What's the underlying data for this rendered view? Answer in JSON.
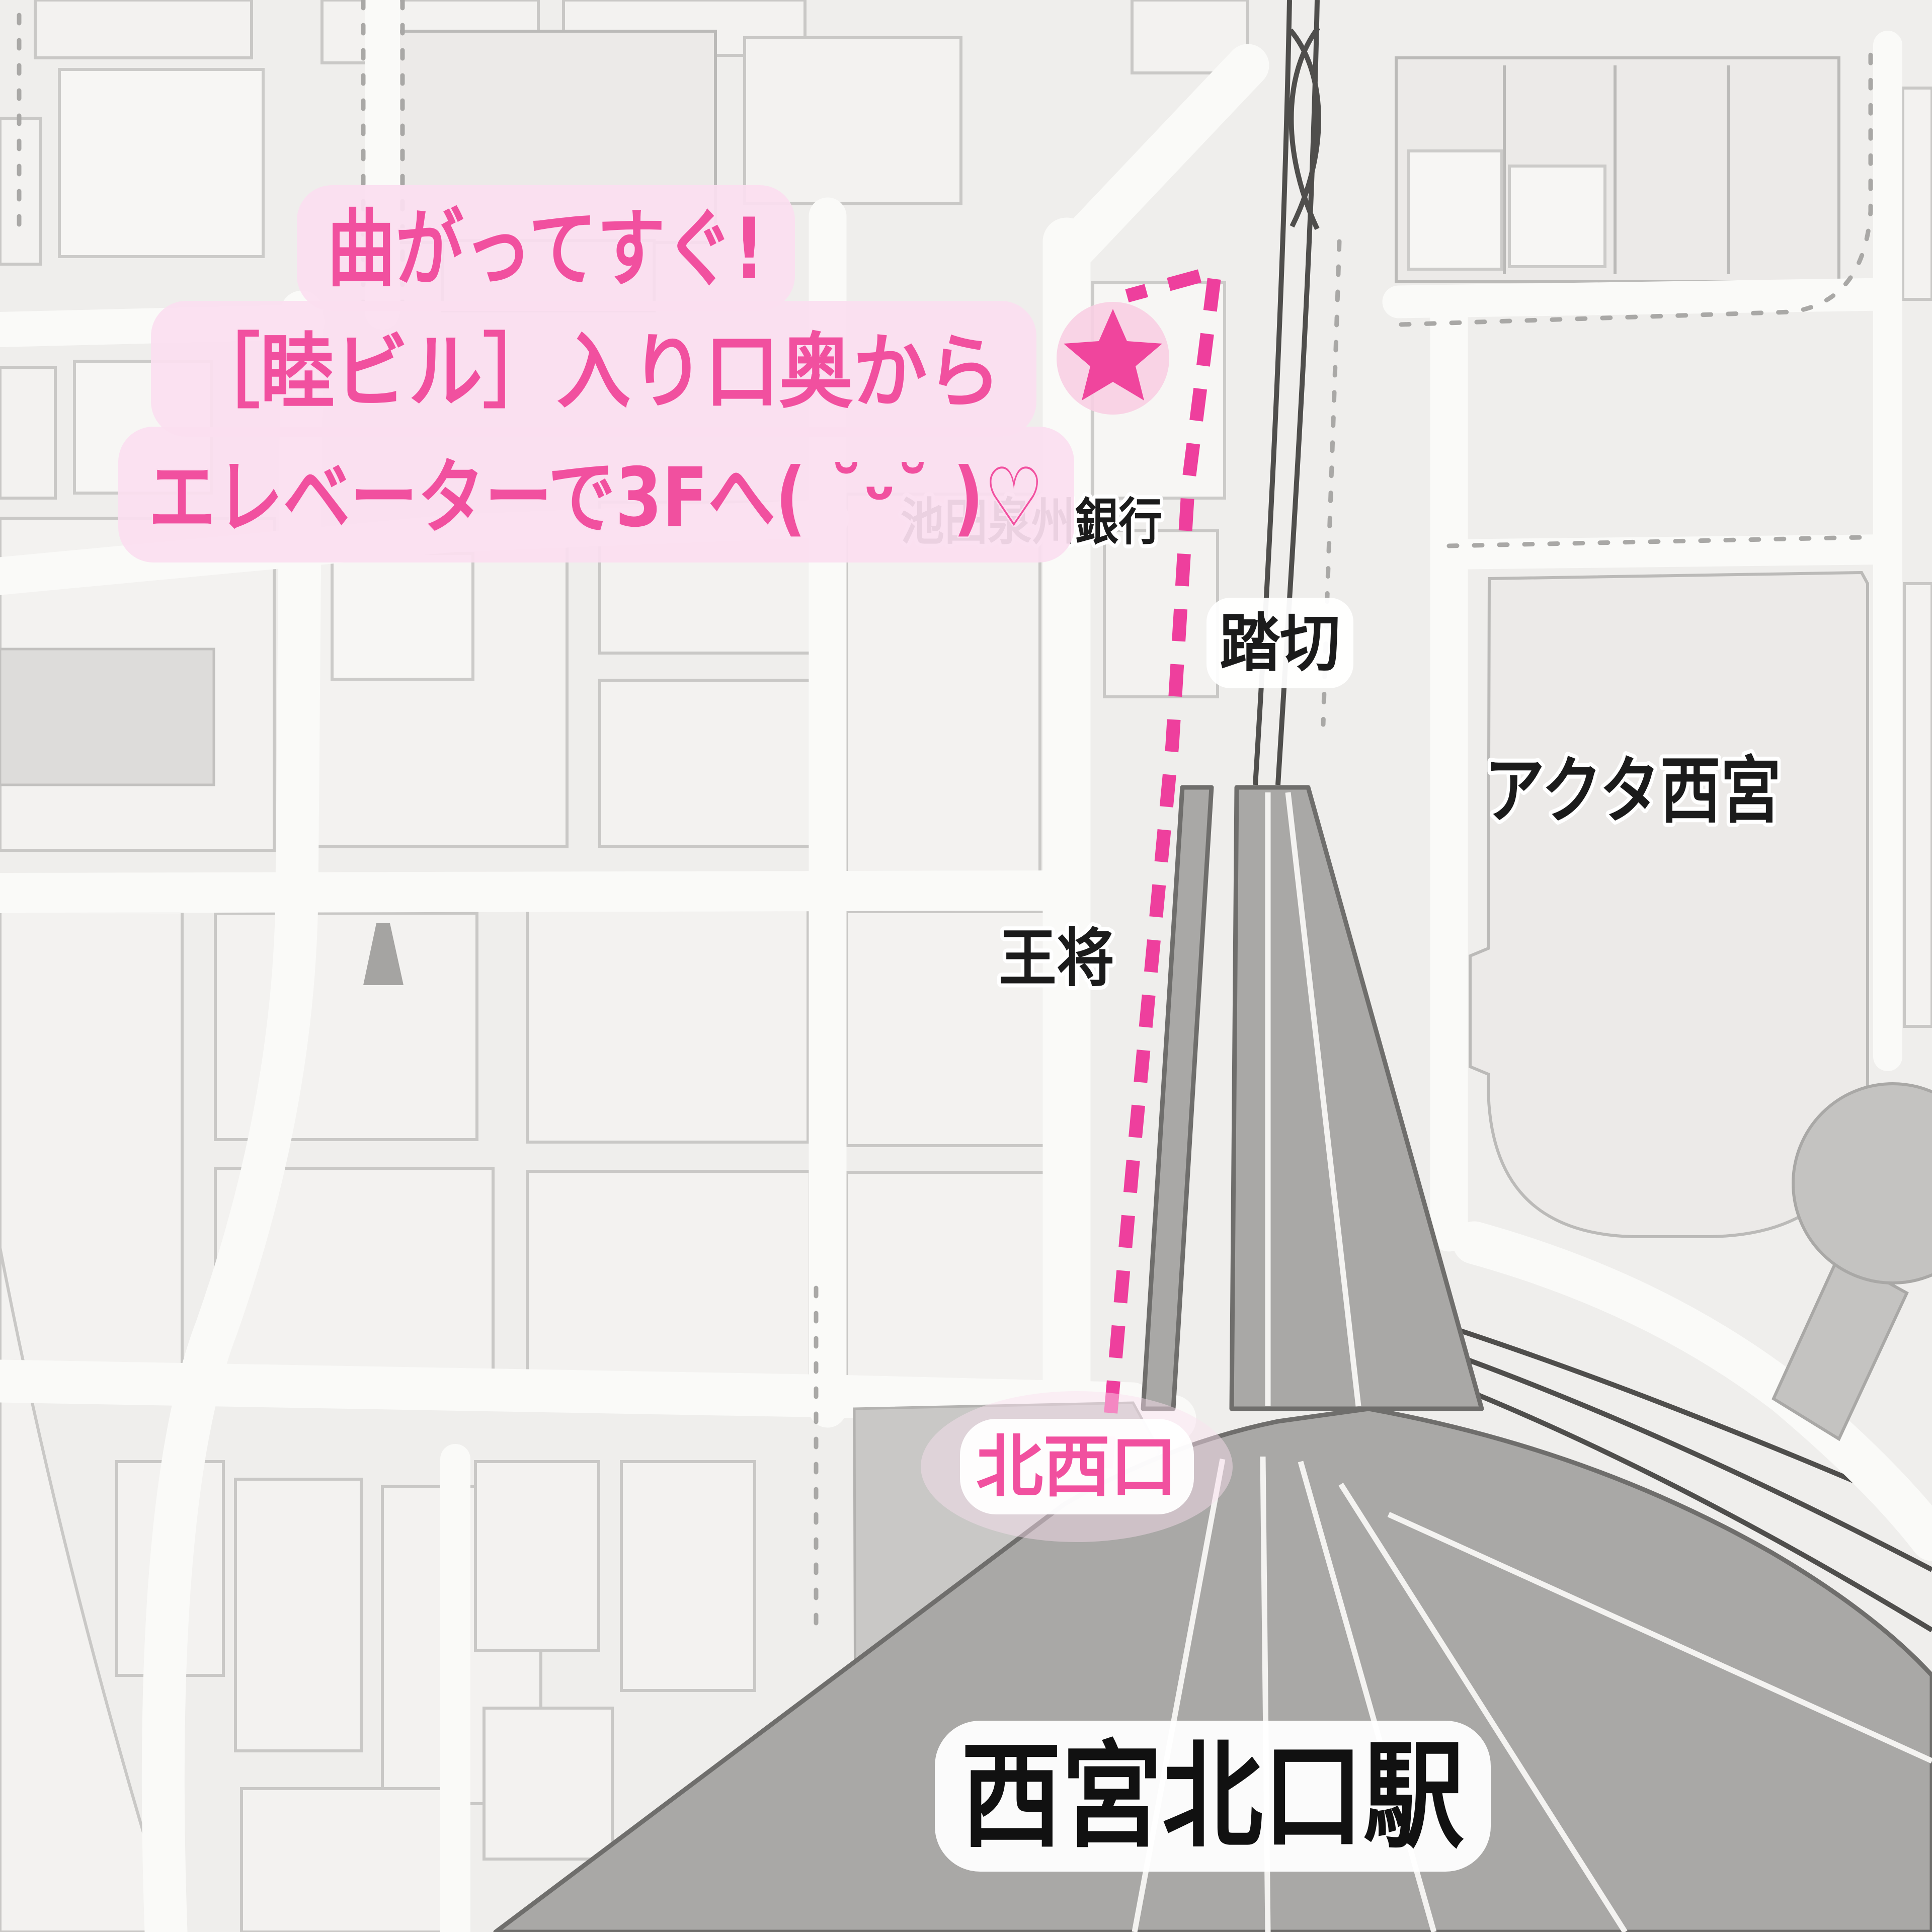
{
  "map": {
    "annotation": {
      "line1": "曲がってすぐ!",
      "line2": "［睦ビル］入り口奥から",
      "line3": "エレベーターで3Fへ( ˘ᵕ˘ )♡"
    },
    "labels": {
      "bank": "池田泉州銀行",
      "crossing": "踏切",
      "acta": "アクタ西宮",
      "osho": "王将",
      "northwest_exit": "北西口",
      "station": "西宮北口駅"
    },
    "icons": {
      "destination": "star-icon"
    },
    "colors": {
      "accent_pink": "#f1509f",
      "panel_pink": "#fbdff0",
      "route_pink": "#ee3f9d",
      "star_pink": "#f0459d",
      "star_circle_pink": "#f8cfe3",
      "label_text": "#1b1b1b",
      "bubble_white": "#ffffff",
      "road_white": "#fafaf8",
      "block_fill": "#f3f2f0",
      "station_gray": "#a9a8a6",
      "plaza_gray": "#c9c8c6",
      "rail_dark": "#4f4e4c",
      "background": "#efeeec"
    }
  }
}
